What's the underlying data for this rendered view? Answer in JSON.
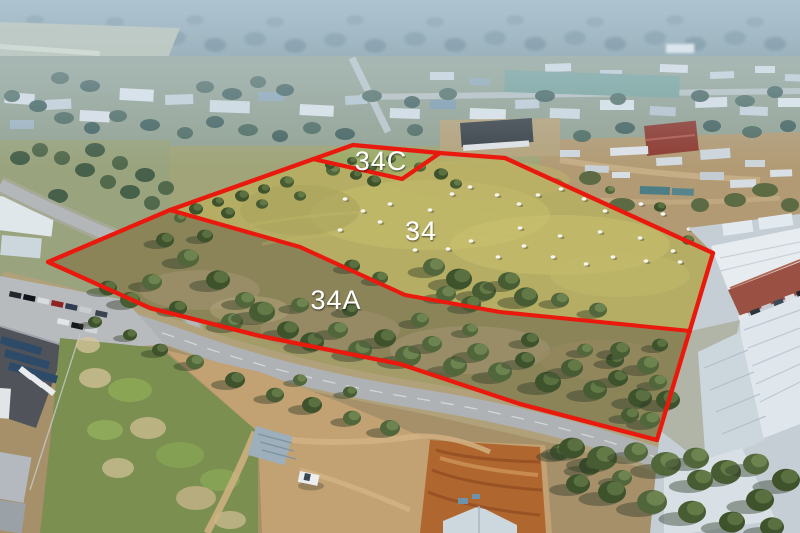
{
  "overlay": {
    "boundary_color": "#e9190d",
    "label_color": "#ffffff",
    "lots": [
      {
        "id": "lot-34",
        "label": "34"
      },
      {
        "id": "lot-34a",
        "label": "34A"
      },
      {
        "id": "lot-34c",
        "label": "34C"
      }
    ]
  }
}
